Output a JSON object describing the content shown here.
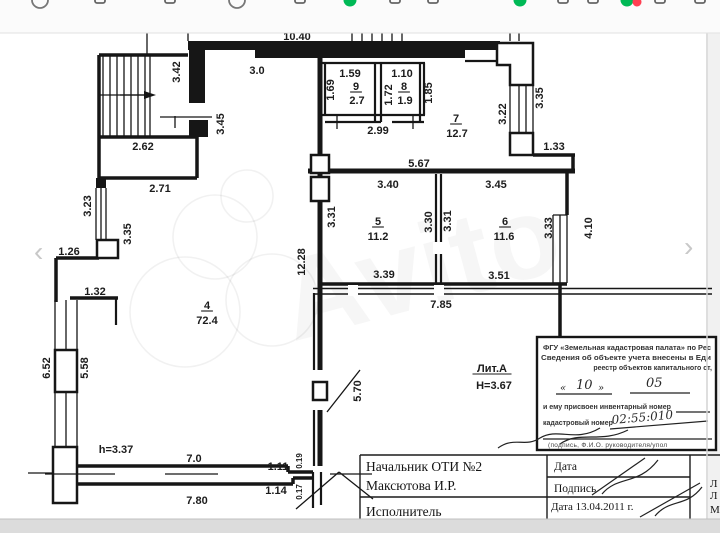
{
  "colors": {
    "accent_green": "#00b956",
    "accent_red": "#ff4053",
    "wall": "#161616",
    "edge": "#d4d4d4"
  },
  "toolbar": {
    "icons": [
      {
        "n": "browser",
        "type": "ring",
        "x": 40
      },
      {
        "n": "browser",
        "type": "glyph",
        "x": 100
      },
      {
        "n": "browser",
        "type": "glyph",
        "x": 170
      },
      {
        "n": "browser",
        "type": "ring",
        "x": 237
      },
      {
        "n": "browser",
        "type": "glyph",
        "x": 300
      },
      {
        "n": "notification-dot",
        "type": "green",
        "x": 350
      },
      {
        "n": "browser",
        "type": "glyph",
        "x": 395
      },
      {
        "n": "browser",
        "type": "glyph",
        "x": 433
      },
      {
        "n": "notification-dot",
        "type": "green",
        "x": 520
      },
      {
        "n": "browser",
        "type": "glyph",
        "x": 563
      },
      {
        "n": "browser",
        "type": "glyph",
        "x": 593
      },
      {
        "n": "notification-dot",
        "type": "green",
        "x": 627
      },
      {
        "n": "notification-dot",
        "type": "red",
        "x": 637
      },
      {
        "n": "browser",
        "type": "glyph",
        "x": 660
      },
      {
        "n": "browser",
        "type": "glyph",
        "x": 700
      }
    ]
  },
  "gallery": {
    "prev": "‹",
    "next": "›"
  },
  "watermark": {
    "text": "Avito"
  },
  "plan": {
    "labels": [
      {
        "t": "10.40",
        "x": 297,
        "y": 36
      },
      {
        "t": "3.42",
        "x": 176,
        "y": 72,
        "r": 1
      },
      {
        "t": "3.0",
        "x": 257,
        "y": 70
      },
      {
        "t": "3.45",
        "x": 220,
        "y": 124,
        "r": 1
      },
      {
        "t": "2.62",
        "x": 143,
        "y": 146
      },
      {
        "t": "2.71",
        "x": 160,
        "y": 188
      },
      {
        "t": "3.23",
        "x": 87,
        "y": 206,
        "r": 1
      },
      {
        "t": "3.35",
        "x": 127,
        "y": 234,
        "r": 1
      },
      {
        "t": "1.26",
        "x": 69,
        "y": 251
      },
      {
        "t": "1.32",
        "x": 95,
        "y": 291
      },
      {
        "t": "6.52",
        "x": 46,
        "y": 368,
        "r": 1
      },
      {
        "t": "5.58",
        "x": 84,
        "y": 368,
        "r": 1
      },
      {
        "t": "h=3.37",
        "x": 116,
        "y": 449
      },
      {
        "t": "7.0",
        "x": 194,
        "y": 458
      },
      {
        "t": "7.80",
        "x": 197,
        "y": 500
      },
      {
        "t": "1.11",
        "x": 278,
        "y": 466
      },
      {
        "t": "1.14",
        "x": 276,
        "y": 490
      },
      {
        "t": "0.19",
        "x": 298,
        "y": 461,
        "r": 1,
        "s": 8
      },
      {
        "t": "0.17",
        "x": 298,
        "y": 492,
        "r": 1,
        "s": 8
      },
      {
        "t": "12.28",
        "x": 301,
        "y": 262,
        "r": 1
      },
      {
        "t": "4",
        "x": 207,
        "y": 305,
        "u": 1
      },
      {
        "t": "72.4",
        "x": 207,
        "y": 320
      },
      {
        "t": "1.59",
        "x": 350,
        "y": 73
      },
      {
        "t": "1.69",
        "x": 330,
        "y": 90,
        "r": 1
      },
      {
        "t": "9",
        "x": 356,
        "y": 86,
        "u": 1
      },
      {
        "t": "2.7",
        "x": 357,
        "y": 100
      },
      {
        "t": "1.10",
        "x": 402,
        "y": 73
      },
      {
        "t": "1.72",
        "x": 388,
        "y": 95,
        "r": 1
      },
      {
        "t": "8",
        "x": 404,
        "y": 86,
        "u": 1
      },
      {
        "t": "1.9",
        "x": 405,
        "y": 100
      },
      {
        "t": "1.85",
        "x": 428,
        "y": 93,
        "r": 1
      },
      {
        "t": "2.99",
        "x": 378,
        "y": 130
      },
      {
        "t": "7",
        "x": 456,
        "y": 118,
        "u": 1
      },
      {
        "t": "12.7",
        "x": 457,
        "y": 133
      },
      {
        "t": "1.3",
        "x": 524,
        "y": 25,
        "r": 1
      },
      {
        "t": "3.22",
        "x": 502,
        "y": 114,
        "r": 1
      },
      {
        "t": "3.35",
        "x": 539,
        "y": 98,
        "r": 1
      },
      {
        "t": "1.33",
        "x": 554,
        "y": 146
      },
      {
        "t": "5.67",
        "x": 419,
        "y": 163
      },
      {
        "t": "3.40",
        "x": 388,
        "y": 184
      },
      {
        "t": "3.45",
        "x": 496,
        "y": 184
      },
      {
        "t": "3.31",
        "x": 331,
        "y": 217,
        "r": 1
      },
      {
        "t": "5",
        "x": 378,
        "y": 221,
        "u": 1
      },
      {
        "t": "11.2",
        "x": 378,
        "y": 236
      },
      {
        "t": "3.30",
        "x": 428,
        "y": 222,
        "r": 1
      },
      {
        "t": "3.31",
        "x": 447,
        "y": 221,
        "r": 1
      },
      {
        "t": "6",
        "x": 505,
        "y": 221,
        "u": 1
      },
      {
        "t": "11.6",
        "x": 504,
        "y": 236
      },
      {
        "t": "3.33",
        "x": 548,
        "y": 228,
        "r": 1
      },
      {
        "t": "4.10",
        "x": 588,
        "y": 228,
        "r": 1
      },
      {
        "t": "3.39",
        "x": 384,
        "y": 274
      },
      {
        "t": "3.51",
        "x": 499,
        "y": 275
      },
      {
        "t": "7.85",
        "x": 441,
        "y": 304
      },
      {
        "t": "5.70",
        "x": 357,
        "y": 391,
        "r": 1
      },
      {
        "t": "Лит.А",
        "x": 492,
        "y": 368,
        "u": 1
      },
      {
        "t": "H=3.67",
        "x": 494,
        "y": 385
      }
    ]
  },
  "stamp": {
    "line1": "ФГУ «Земельная кадастровая палата» по Рес",
    "line2": "Сведения об объекте учета внесены в Еди",
    "line3": "реестр объектов капитального ст,",
    "quote_open": "«",
    "quote_close": "»",
    "hand_day": "10",
    "hand_month": "05",
    "line4": "и ему присвоен инвентарный номер",
    "line5": "кадастровый номер",
    "hand_number": "02:55:010",
    "line6": "(подпись, Ф.И.О. руководителя/упол"
  },
  "table": {
    "officer_line1": "Начальник ОТИ №2",
    "officer_line2": "Максютова И.Р.",
    "executor": "Исполнитель",
    "cell_date": "Дата",
    "cell_sign": "Подпись",
    "cell_date2": "Дата 13.04.2011 г.",
    "side": [
      "Л",
      "Л",
      "М"
    ]
  }
}
